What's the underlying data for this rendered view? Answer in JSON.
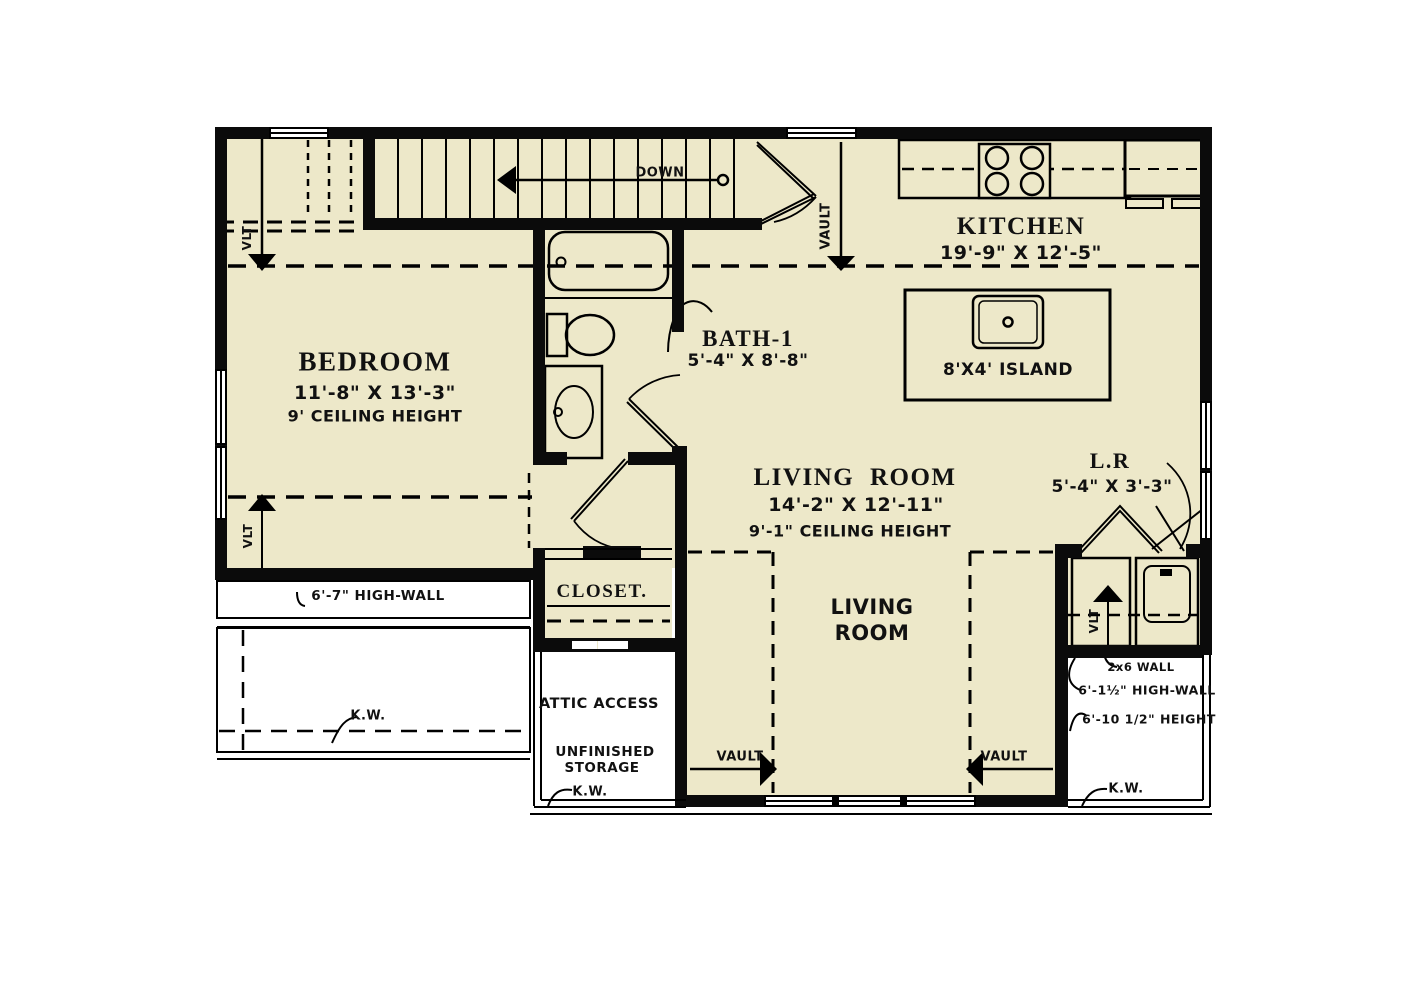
{
  "plan": {
    "colors": {
      "floor": "#EDE8C9",
      "wall": "#0B0B0B",
      "paper": "#FFFFFF"
    },
    "rooms": {
      "bedroom": {
        "name": "BEDROOM",
        "dims": "11'-8\" X 13'-3\"",
        "ceiling": "9' CEILING HEIGHT"
      },
      "bath": {
        "name": "BATH-1",
        "dims": "5'-4\" X 8'-8\""
      },
      "kitchen": {
        "name": "KITCHEN",
        "dims": "19'-9\" X 12'-5\""
      },
      "island": {
        "label": "8'X4' ISLAND"
      },
      "living": {
        "name": "LIVING ROOM",
        "dims": "14'-2\" X 12'-11\"",
        "ceiling": "9'-1\" CEILING HEIGHT",
        "floor_label_line1": "LIVING",
        "floor_label_line2": "ROOM"
      },
      "laundry": {
        "name": "L.R",
        "dims": "5'-4\" X 3'-3\""
      },
      "closet": {
        "name": "CLOSET."
      },
      "attic": {
        "line1": "ATTIC ACCESS",
        "line2": "UNFINISHED",
        "line3": "STORAGE"
      }
    },
    "annotations": {
      "down": "DOWN",
      "vault": "VAULT",
      "vlt": "VLT",
      "kw": "K.W.",
      "high_wall_left": "6'-7\" HIGH-WALL",
      "wall_2x6": "2x6 WALL",
      "high_wall_right": "6'-1½\" HIGH-WALL",
      "height_right": "6'-10 1/2\" HEIGHT"
    }
  }
}
